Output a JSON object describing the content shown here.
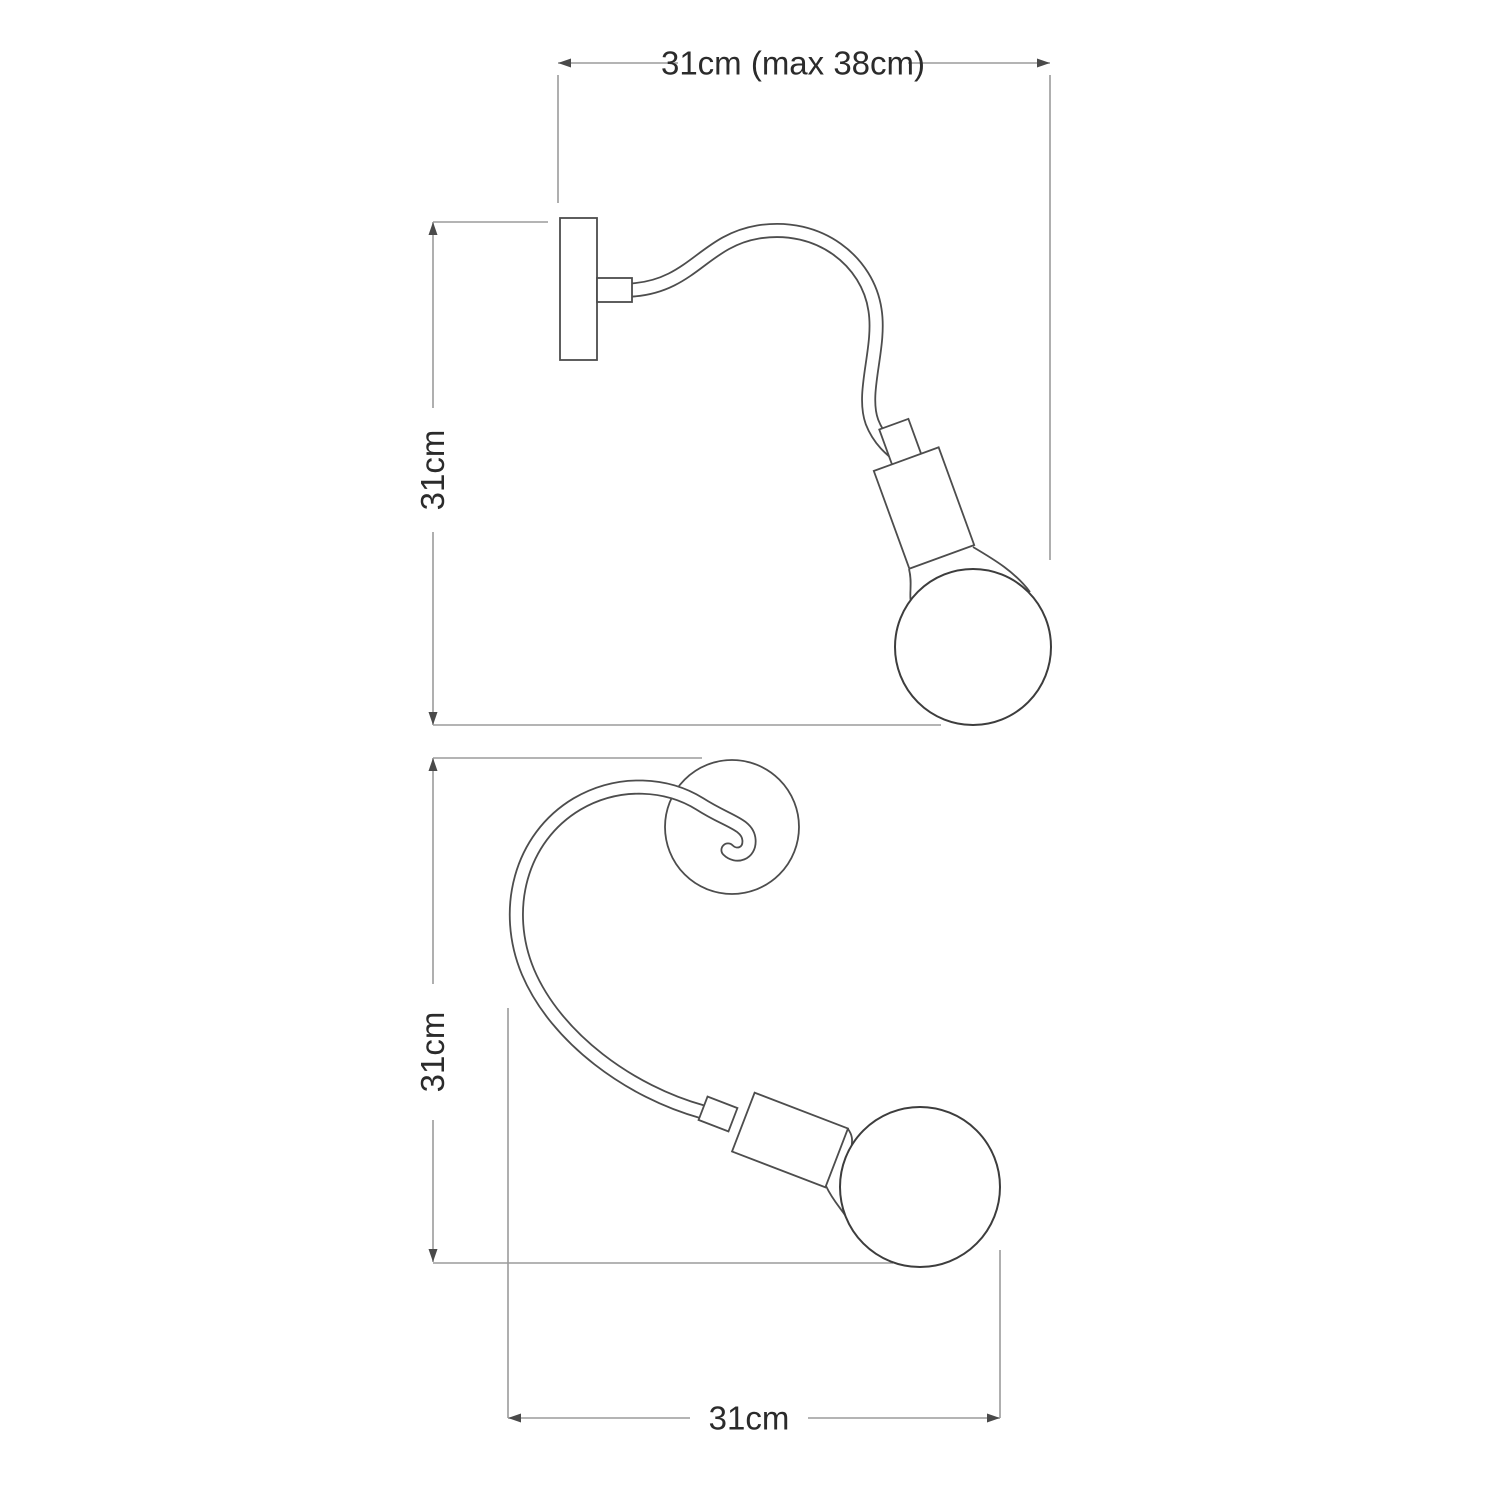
{
  "colors": {
    "background": "#ffffff",
    "lamp_outline": "#4d4d4d",
    "bulb_outline": "#3d3d3d",
    "dimension_line": "#9b9b9b",
    "arrowhead": "#4a4a4a",
    "label_text": "#2b2b2b"
  },
  "views": {
    "side": {
      "width_dimension_label": "31cm (max 38cm)",
      "height_dimension_label": "31cm"
    },
    "front": {
      "height_dimension_label": "31cm",
      "width_dimension_label": "31cm"
    }
  }
}
